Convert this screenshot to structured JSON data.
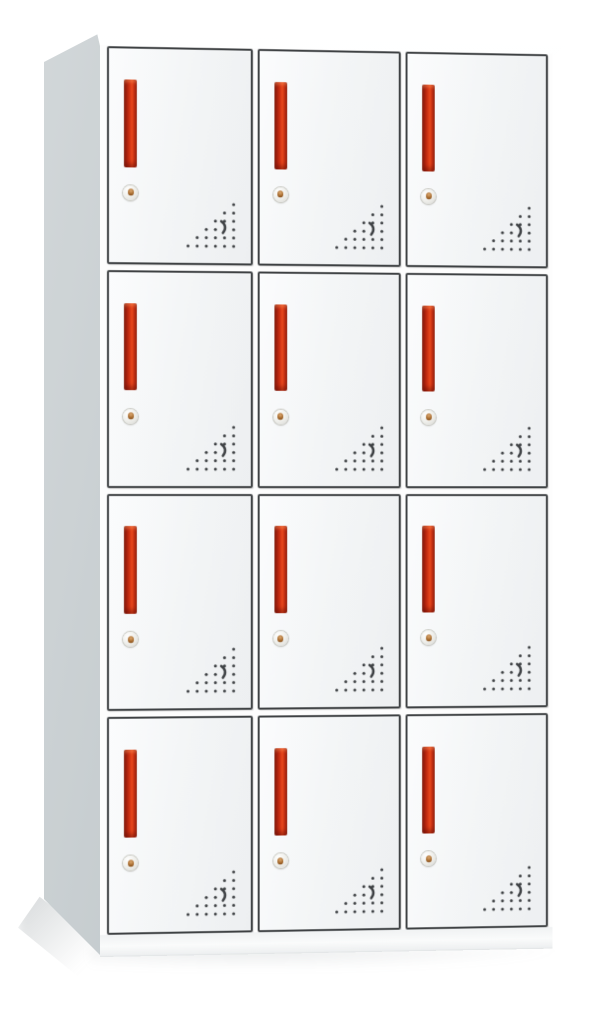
{
  "scene": {
    "description": "Product photo of a white steel office locker cabinet with twelve compartments, viewed from the front-left with slight perspective, on a plain white background",
    "background": "#ffffff"
  },
  "cabinet": {
    "rows": 4,
    "columns": 3,
    "door_count": 12,
    "colors": {
      "background": "#ffffff",
      "door_face": "#f3f5f6",
      "door_outline": "#3e4143",
      "handle_red": "#d23414",
      "handle_bright": "#e8491d",
      "handle_dark": "#7c150a",
      "side_panel": "#c2c9cc",
      "top_panel": "#fafbfb",
      "frame_white": "#fdfdfd",
      "vent_dot": "#3d4043",
      "lock_body": "#dededa",
      "lock_keyhole": "#a5692c"
    },
    "door_features": {
      "handle": "vertical recessed red bar handle, upper-left of each door",
      "lock": "round silver cam lock with brass keyhole below the handle",
      "vent": "triangular perforation pattern of small holes with a curved slot, lower-right of each door",
      "vent_rows": 6,
      "vent_hole_count": 20,
      "vent_has_curved_slot": true
    },
    "doors": [
      {
        "id": "r1c1",
        "row": 1,
        "col": 1
      },
      {
        "id": "r1c2",
        "row": 1,
        "col": 2
      },
      {
        "id": "r1c3",
        "row": 1,
        "col": 3
      },
      {
        "id": "r2c1",
        "row": 2,
        "col": 1
      },
      {
        "id": "r2c2",
        "row": 2,
        "col": 2
      },
      {
        "id": "r2c3",
        "row": 2,
        "col": 3
      },
      {
        "id": "r3c1",
        "row": 3,
        "col": 1
      },
      {
        "id": "r3c2",
        "row": 3,
        "col": 2
      },
      {
        "id": "r3c3",
        "row": 3,
        "col": 3
      },
      {
        "id": "r4c1",
        "row": 4,
        "col": 1
      },
      {
        "id": "r4c2",
        "row": 4,
        "col": 2
      },
      {
        "id": "r4c3",
        "row": 4,
        "col": 3
      }
    ]
  }
}
